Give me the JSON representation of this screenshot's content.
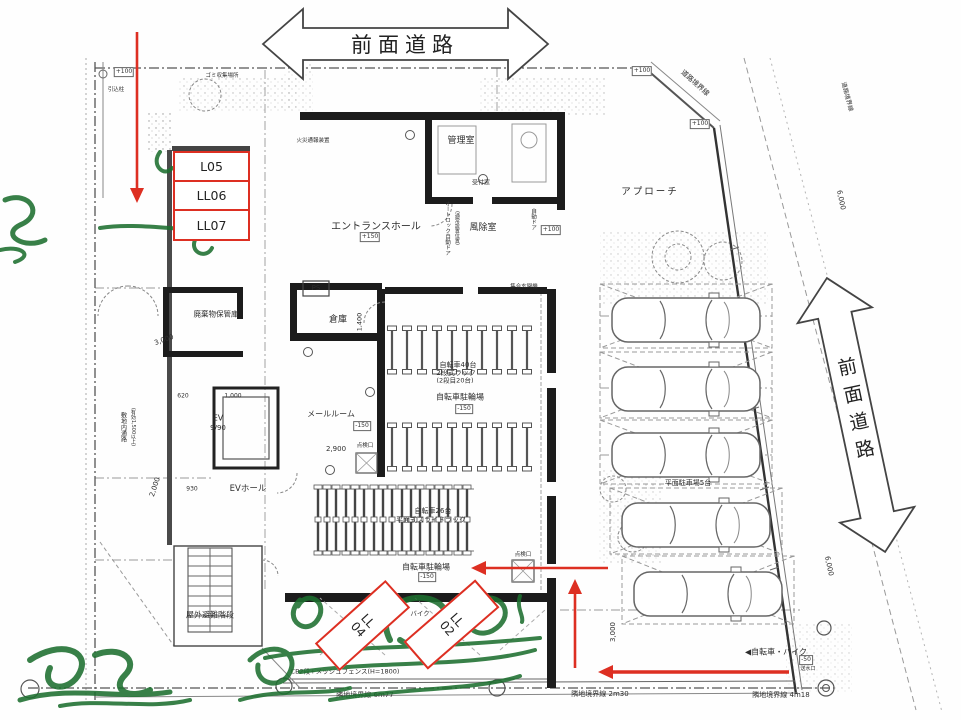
{
  "annotation": {
    "red": "#dd2f22",
    "green": "#1d6f2f",
    "units_left": {
      "u1": "L05",
      "u2": "LL06",
      "u3": "LL07"
    },
    "units_bottom": {
      "u1": "LL04",
      "u2": "LL02"
    }
  },
  "roads": {
    "top": "前面道路",
    "right": "前面道路"
  },
  "boundaries": {
    "road_diag": "道路境界線",
    "road_right": "道路境界線",
    "neighbor_sw": "隣地境界線 6m77",
    "neighbor_s": "隣地境界線 2m30",
    "neighbor_se": "隣地境界線 4m18",
    "fence": "CB2段+メッシュフェンス(H=1800)"
  },
  "rooms": {
    "manager": "管理室",
    "windbreak": "風除室",
    "entrance_hall": "エントランスホール",
    "reception_window": "受付窓",
    "entry_panel": "集合玄関機",
    "autolock_door": "オートロック自動ドア",
    "autolock_note": "(通常設置位置)",
    "auto_door": "自動ドア",
    "fire_phone": "火災通報装置",
    "ps": "PS",
    "storage": "倉庫",
    "mail_room": "メールルーム",
    "ev": "EV",
    "ev_capacity": "9/90",
    "ev_hall": "EVホール",
    "waste_storage": "廃棄物保管庫",
    "site_passage": "敷地内通路",
    "site_passage_note": "(有効1,500以上)",
    "outdoor_stairs": "屋外避難階段",
    "trash_area": "ゴミ収集場所",
    "lead_in_pole": "引込柱",
    "bike40": "自転車40台",
    "bike40_rack": "2段式ラック",
    "bike40_note": "(2段目20台)",
    "bike_lot_upper": "自転車駐輪場",
    "bike26": "自転車26台",
    "bike26_rack": "平面式スライドラック",
    "bike_lot_lower": "自転車駐輪場",
    "moto": "バイク",
    "approach": "アプローチ",
    "flat_parking": "平面駐車場5台",
    "bike_moto_dir": "◀自転車・バイク",
    "hatch1": "点検口",
    "hatch2": "点検口",
    "standpipe": "送水口"
  },
  "levels": {
    "entrance": "+150",
    "mail": "-150",
    "bike_upper": "-150",
    "bike_lower": "-150",
    "drain": "-50",
    "t1": "+100",
    "t2": "+100",
    "t3": "+100",
    "w1": "+100"
  },
  "dims": {
    "d3000r": "3,000",
    "d3000l": "3,000",
    "d2000": "2,000",
    "d6000t": "6,000",
    "d6000b": "6,000",
    "d1400": "1,400",
    "d2900": "2,900",
    "d620": "620",
    "d930": "930",
    "d1000": "1,000"
  }
}
